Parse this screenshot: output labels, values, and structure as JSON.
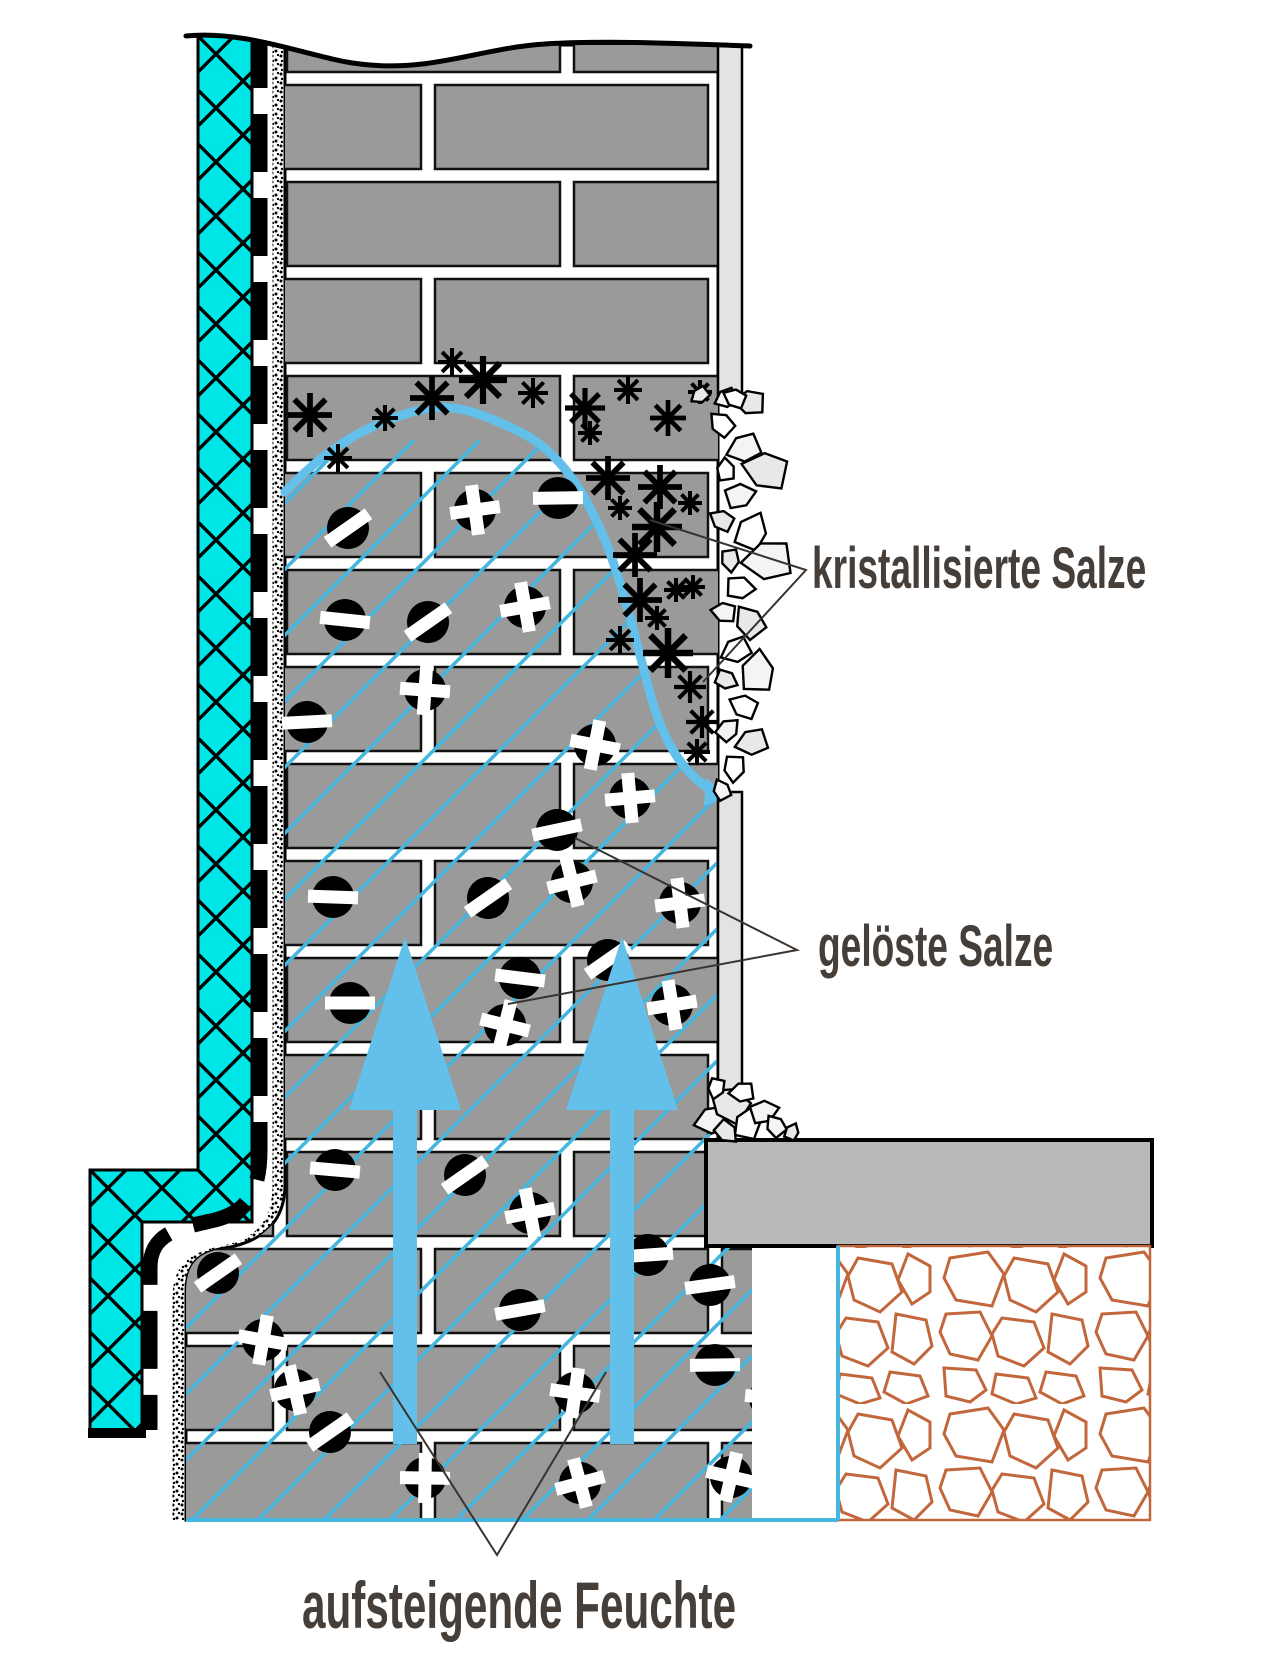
{
  "labels": {
    "crystallized": {
      "text": "kristallisierte Salze",
      "x": 812,
      "y": 588,
      "size": 58
    },
    "dissolved": {
      "text": "gelöste Salze",
      "x": 818,
      "y": 966,
      "size": 58
    },
    "rising": {
      "text": "aufsteigende Feuchte",
      "x": 302,
      "y": 1628,
      "size": 66
    }
  },
  "colors": {
    "insulation": "#00e6e6",
    "brick": "#9a9a9a",
    "brick_outline": "#111111",
    "mortar": "#ffffff",
    "moisture": "#62c0ea",
    "hatch": "#45b6e0",
    "slab": "#b9b9b9",
    "plaster": "#e3e3e3",
    "shard": "#efefef",
    "gravel": "#c2673c",
    "label_text": "#453e39",
    "pointer": "#3a332e",
    "black": "#000000"
  },
  "diagram": {
    "asterisks": [
      [
        310,
        415,
        22
      ],
      [
        385,
        418,
        13
      ],
      [
        432,
        398,
        22
      ],
      [
        483,
        380,
        24
      ],
      [
        533,
        393,
        15
      ],
      [
        338,
        458,
        14
      ],
      [
        452,
        362,
        14
      ],
      [
        585,
        408,
        20
      ],
      [
        628,
        390,
        14
      ],
      [
        668,
        418,
        18
      ],
      [
        700,
        392,
        12
      ],
      [
        590,
        433,
        12
      ],
      [
        608,
        478,
        22
      ],
      [
        660,
        487,
        22
      ],
      [
        620,
        508,
        12
      ],
      [
        657,
        527,
        25
      ],
      [
        690,
        503,
        12
      ],
      [
        635,
        555,
        22
      ],
      [
        676,
        590,
        12
      ],
      [
        640,
        600,
        22
      ],
      [
        693,
        587,
        12
      ],
      [
        657,
        618,
        12
      ],
      [
        620,
        640,
        14
      ],
      [
        668,
        653,
        25
      ],
      [
        690,
        687,
        16
      ],
      [
        702,
        722,
        16
      ],
      [
        697,
        752,
        13
      ]
    ],
    "salt_circles": [
      [
        348,
        528,
        "slash"
      ],
      [
        475,
        510,
        "plus"
      ],
      [
        558,
        498,
        "minus"
      ],
      [
        345,
        620,
        "minus"
      ],
      [
        428,
        622,
        "slash"
      ],
      [
        525,
        607,
        "plus"
      ],
      [
        307,
        722,
        "minus"
      ],
      [
        425,
        690,
        "plus"
      ],
      [
        595,
        745,
        "plus"
      ],
      [
        557,
        830,
        "minus"
      ],
      [
        630,
        798,
        "plus"
      ],
      [
        333,
        897,
        "minus"
      ],
      [
        488,
        898,
        "slash"
      ],
      [
        572,
        882,
        "plus"
      ],
      [
        680,
        903,
        "plus"
      ],
      [
        350,
        1003,
        "minus"
      ],
      [
        520,
        978,
        "minus"
      ],
      [
        505,
        1025,
        "plus"
      ],
      [
        672,
        1005,
        "plus"
      ],
      [
        608,
        960,
        "slash"
      ],
      [
        335,
        1170,
        "minus"
      ],
      [
        465,
        1175,
        "slash"
      ],
      [
        530,
        1213,
        "plus"
      ],
      [
        648,
        1255,
        "minus"
      ],
      [
        218,
        1273,
        "slash"
      ],
      [
        263,
        1340,
        "plus"
      ],
      [
        295,
        1390,
        "plus"
      ],
      [
        330,
        1432,
        "slash"
      ],
      [
        425,
        1478,
        "plus"
      ],
      [
        575,
        1393,
        "plus"
      ],
      [
        580,
        1483,
        "plus"
      ],
      [
        710,
        1285,
        "minus"
      ],
      [
        715,
        1365,
        "minus"
      ],
      [
        770,
        1398,
        "plus"
      ],
      [
        731,
        1477,
        "plus"
      ],
      [
        520,
        1310,
        "minus"
      ]
    ],
    "arrows": {
      "tip_y": 937,
      "base_y": 1110,
      "half_head": 56,
      "half_stem": 12,
      "bottom_y": 1444,
      "items": [
        {
          "cx": 405
        },
        {
          "cx": 622
        }
      ]
    },
    "shards_band": [
      [
        726,
        398,
        12,
        10
      ],
      [
        750,
        402,
        16,
        40
      ],
      [
        722,
        424,
        14,
        80
      ],
      [
        744,
        448,
        18,
        15
      ],
      [
        766,
        470,
        24,
        50
      ],
      [
        726,
        470,
        12,
        120
      ],
      [
        740,
        496,
        16,
        200
      ],
      [
        722,
        520,
        13,
        65
      ],
      [
        752,
        532,
        20,
        150
      ],
      [
        768,
        560,
        26,
        30
      ],
      [
        730,
        560,
        12,
        300
      ],
      [
        740,
        588,
        15,
        220
      ],
      [
        724,
        612,
        13,
        45
      ],
      [
        750,
        622,
        18,
        90
      ],
      [
        736,
        650,
        16,
        10
      ],
      [
        758,
        672,
        22,
        130
      ],
      [
        726,
        680,
        12,
        240
      ],
      [
        744,
        706,
        15,
        60
      ],
      [
        728,
        730,
        13,
        170
      ],
      [
        752,
        742,
        17,
        20
      ],
      [
        734,
        768,
        14,
        310
      ],
      [
        722,
        790,
        11,
        100
      ],
      [
        700,
        395,
        10,
        0
      ],
      [
        735,
        398,
        12,
        60
      ]
    ],
    "shards_pile": [
      [
        712,
        1120,
        18,
        20
      ],
      [
        730,
        1104,
        22,
        70
      ],
      [
        748,
        1124,
        17,
        140
      ],
      [
        764,
        1112,
        15,
        200
      ],
      [
        726,
        1132,
        13,
        260
      ],
      [
        742,
        1092,
        13,
        30
      ],
      [
        776,
        1126,
        12,
        90
      ],
      [
        792,
        1132,
        9,
        150
      ],
      [
        716,
        1088,
        11,
        320
      ]
    ],
    "pointers": [
      {
        "name": "crystallized",
        "points": [
          [
            650,
            520
          ],
          [
            806,
            570
          ],
          [
            703,
            682
          ]
        ]
      },
      {
        "name": "dissolved",
        "points": [
          [
            575,
            838
          ],
          [
            797,
            950
          ],
          [
            508,
            1004
          ]
        ]
      },
      {
        "name": "rising",
        "points": [
          [
            380,
            1372
          ],
          [
            497,
            1555
          ],
          [
            606,
            1372
          ]
        ]
      }
    ]
  }
}
